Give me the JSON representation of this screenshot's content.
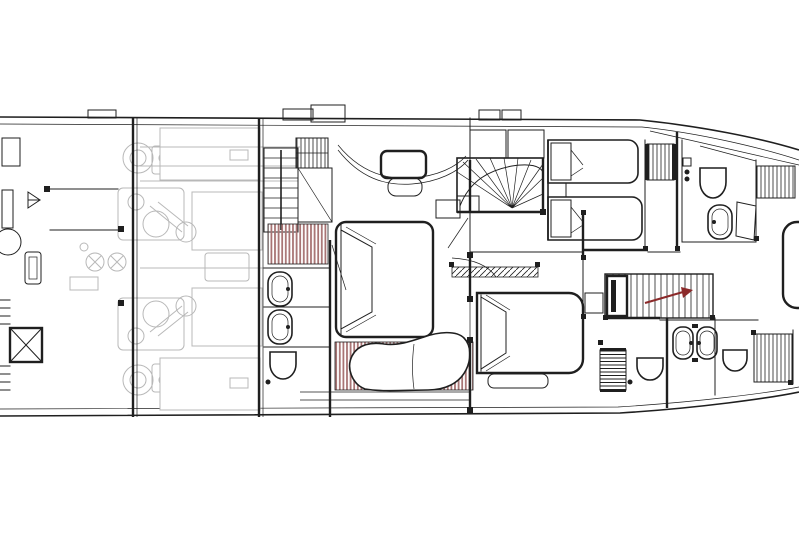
{
  "drawing": {
    "kind": "yacht-lower-deck-floor-plan",
    "colors": {
      "background": "#ffffff",
      "line": "#1f1f1f",
      "faded": "#b8b8b8",
      "accent": "#a87474",
      "arrow": "#8b2a2a"
    },
    "areas": [
      "crew-quarters-aft",
      "engine-room",
      "master-cabin",
      "master-bathroom",
      "central-fan-staircase",
      "twin-guest-cabin",
      "forward-bathroom-starboard",
      "vip-cabin",
      "vip-bathroom",
      "forward-staircase",
      "bow-berth"
    ]
  }
}
